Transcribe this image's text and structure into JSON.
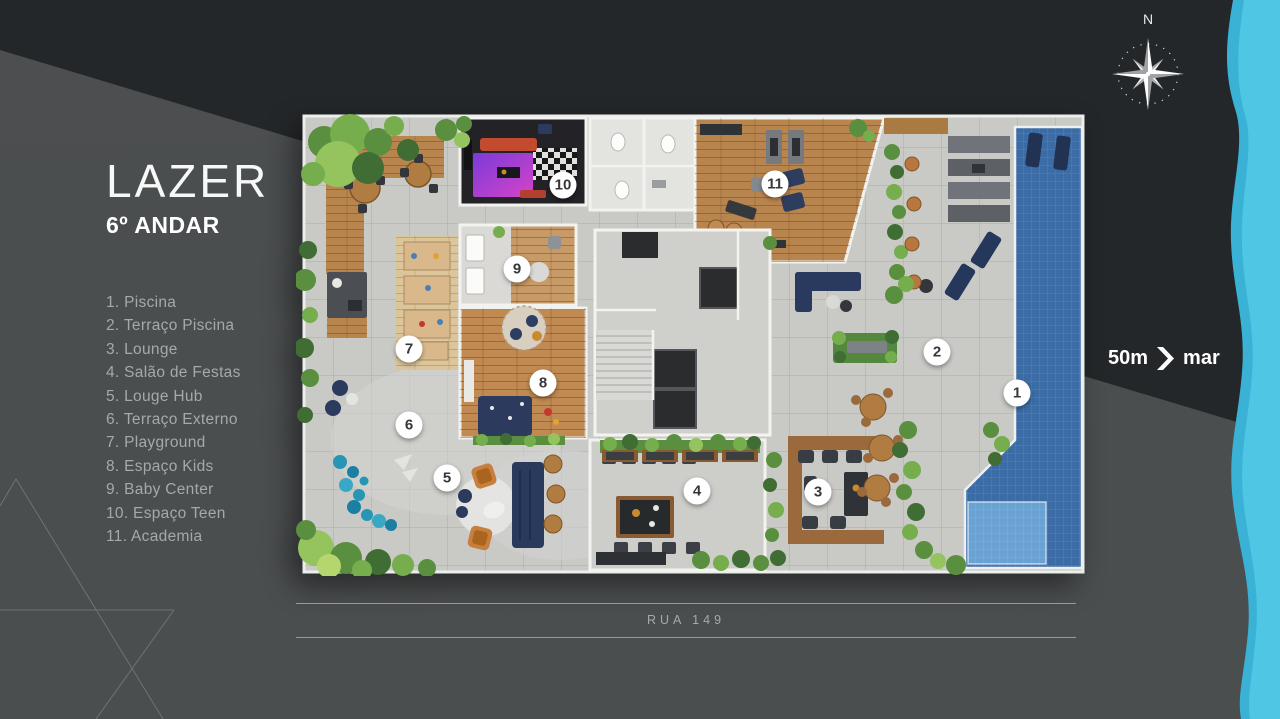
{
  "slide": {
    "title": "LAZER",
    "subtitle": "6º ANDAR",
    "legend": [
      {
        "n": "1.",
        "label": "Piscina"
      },
      {
        "n": "2.",
        "label": "Terraço Piscina"
      },
      {
        "n": "3.",
        "label": "Lounge"
      },
      {
        "n": "4.",
        "label": "Salão de Festas"
      },
      {
        "n": "5.",
        "label": "Louge Hub"
      },
      {
        "n": "6.",
        "label": "Terraço Externo"
      },
      {
        "n": "7.",
        "label": "Playground"
      },
      {
        "n": "8.",
        "label": "Espaço Kids"
      },
      {
        "n": "9.",
        "label": "Baby Center"
      },
      {
        "n": "10.",
        "label": "Espaço Teen"
      },
      {
        "n": "11.",
        "label": "Academia"
      }
    ],
    "plan_markers": [
      {
        "n": "1",
        "label": "Piscina",
        "x": 721,
        "y": 283
      },
      {
        "n": "2",
        "label": "Terraço Piscina",
        "x": 641,
        "y": 242
      },
      {
        "n": "3",
        "label": "Lounge",
        "x": 522,
        "y": 382
      },
      {
        "n": "4",
        "label": "Salão de Festas",
        "x": 401,
        "y": 381
      },
      {
        "n": "5",
        "label": "Louge Hub",
        "x": 151,
        "y": 368
      },
      {
        "n": "6",
        "label": "Terraço Externo",
        "x": 113,
        "y": 315
      },
      {
        "n": "7",
        "label": "Playground",
        "x": 113,
        "y": 239
      },
      {
        "n": "8",
        "label": "Espaço Kids",
        "x": 247,
        "y": 273
      },
      {
        "n": "9",
        "label": "Baby Center",
        "x": 221,
        "y": 159
      },
      {
        "n": "10",
        "label": "Espaço Teen",
        "x": 267,
        "y": 75
      },
      {
        "n": "11",
        "label": "Academia",
        "x": 479,
        "y": 74
      }
    ],
    "street": {
      "label": "RUA 149"
    },
    "compass": {
      "north_label": "N"
    },
    "distance": {
      "value": "50m",
      "target": "mar"
    },
    "colors": {
      "background_dark": "#232629",
      "background_gray": "#4b4e4f",
      "sea_stripe": "#47c0e0",
      "pool_blue": "#3b6ca6",
      "marker_bg": "#ffffff"
    }
  }
}
